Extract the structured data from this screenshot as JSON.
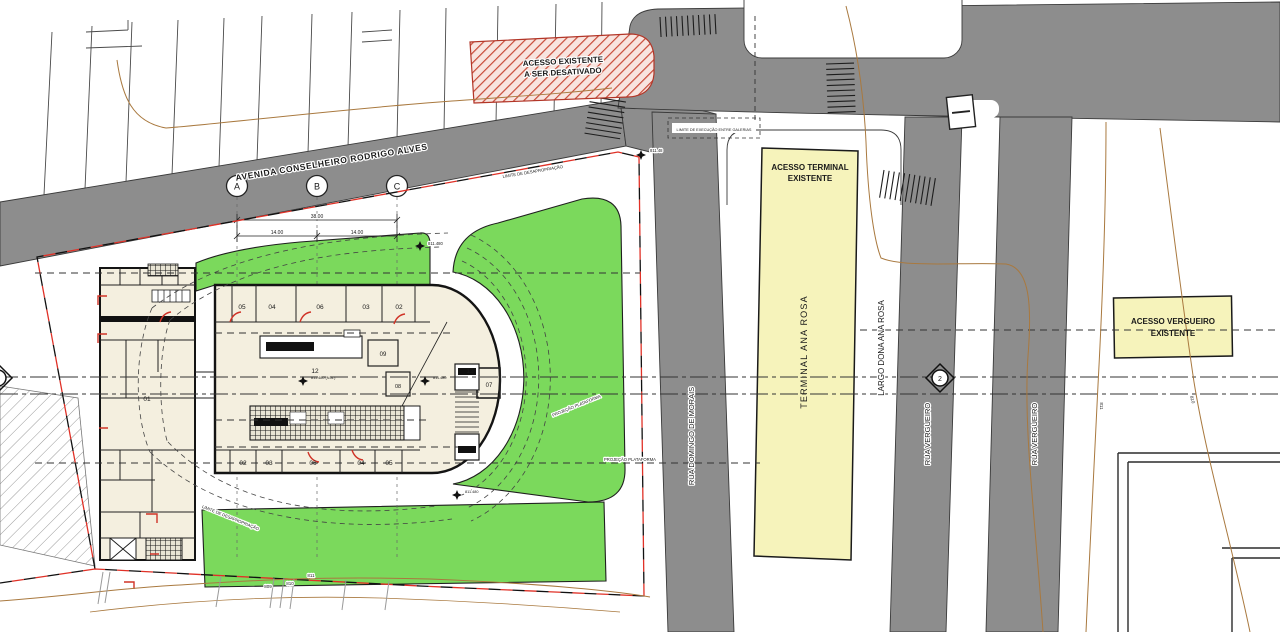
{
  "colors": {
    "road_gray": "#8d8d8d",
    "green": "#7bd95c",
    "yellow": "#f6f3bb",
    "building_cream": "#f4efdf",
    "boundary_red": "#e03127",
    "hatch_red": "#cf4a3c",
    "contour_brown": "#a9793f",
    "pink_label": "#d06a9a"
  },
  "streets": {
    "avenida": "AVENIDA CONSELHEIRO RODRIGO ALVES",
    "rua_domingos": "RUA DOMINGO DE MORAIS",
    "rua_vergueiro_1": "RUA VERGUEIRO",
    "rua_vergueiro_2": "RUA VERGUEIRO",
    "largo": "LARGO DONA ANA ROSA"
  },
  "areas": {
    "terminal_strip": "TERMINAL ANA ROSA",
    "acesso_terminal_1": "ACESSO TERMINAL",
    "acesso_terminal_2": "EXISTENTE",
    "acesso_vergueiro_1": "ACESSO VERGUEIRO",
    "acesso_vergueiro_2": "EXISTENTE",
    "acesso_desativado_1": "ACESSO EXISTENTE",
    "acesso_desativado_2": "A SER DESATIVADO"
  },
  "grid": {
    "a": "A",
    "b": "B",
    "c": "C"
  },
  "dimensions": {
    "total": "38.00",
    "seg1": "14.00",
    "seg2": "14.00"
  },
  "rooms": {
    "annex": "01",
    "top_row": [
      "05",
      "04",
      "06",
      "03",
      "02"
    ],
    "bottom_row": [
      "02",
      "03",
      "06",
      "04",
      "05"
    ],
    "room_09": "09",
    "room_08": "08",
    "room_07": "07",
    "hall_left": "12",
    "hall_right": "12"
  },
  "elevations": {
    "corner": "811.48",
    "top": "811.480",
    "hall_left": "811.480 (N.A.)",
    "hall_right": "811.480",
    "bottom": "811.480"
  },
  "contours": {
    "b809": "809",
    "b810": "810",
    "b811": "811",
    "r811": "811",
    "r810": "810"
  },
  "markers": {
    "section": "2"
  },
  "notes": {
    "limite": "LIMITE DE DESAPROPRIAÇÃO",
    "projecao": "PROJEÇÃO PLATAFORMA",
    "galerias": "LIMITE DE EXECUÇÃO ENTRE GALERIAS"
  }
}
